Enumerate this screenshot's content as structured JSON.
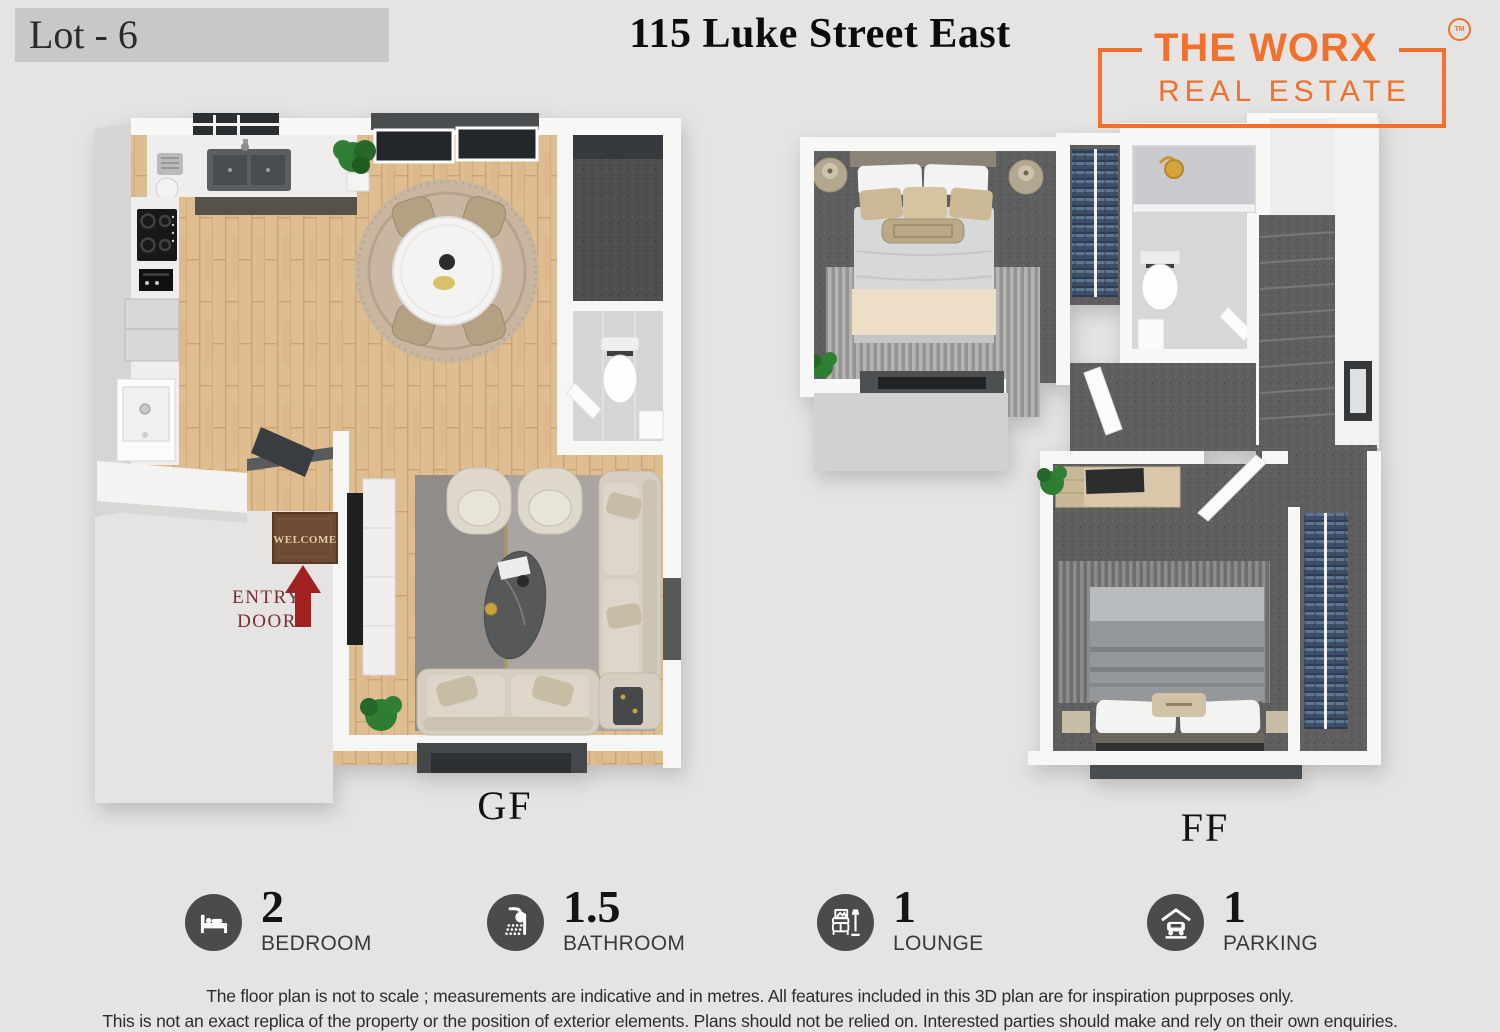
{
  "header": {
    "lot_label": "Lot - 6",
    "title": "115 Luke Street East",
    "logo": {
      "name": "THE WORX",
      "subtitle": "REAL ESTATE",
      "trademark": "TM",
      "accent_color": "#f0702c"
    }
  },
  "plans": {
    "gf": {
      "label": "GF",
      "mat_text": "WELCOME",
      "entry_line1": "ENTRY",
      "entry_line2": "DOOR",
      "entry_color": "#a12121"
    },
    "ff": {
      "label": "FF"
    }
  },
  "features": [
    {
      "icon": "bed-icon",
      "value": "2",
      "label": "BEDROOM"
    },
    {
      "icon": "shower-icon",
      "value": "1.5",
      "label": "BATHROOM"
    },
    {
      "icon": "lounge-icon",
      "value": "1",
      "label": "LOUNGE"
    },
    {
      "icon": "parking-icon",
      "value": "1",
      "label": "PARKING"
    }
  ],
  "disclaimer": {
    "line1": "The floor plan is not to scale ; measurements are indicative and in metres. All features included in this 3D plan are for inspiration puprposes only.",
    "line2": "This is not an exact replica of the property or the position of exterior elements. Plans should not be relied on. Interested parties should make and rely on their own enquiries."
  },
  "colors": {
    "background": "#e5e4e3",
    "icon_circle": "#4b4b4b",
    "mat_brown": "#6e4a34",
    "carpet_gray": "#5f5f5f",
    "wood_floor": "#debd90"
  }
}
